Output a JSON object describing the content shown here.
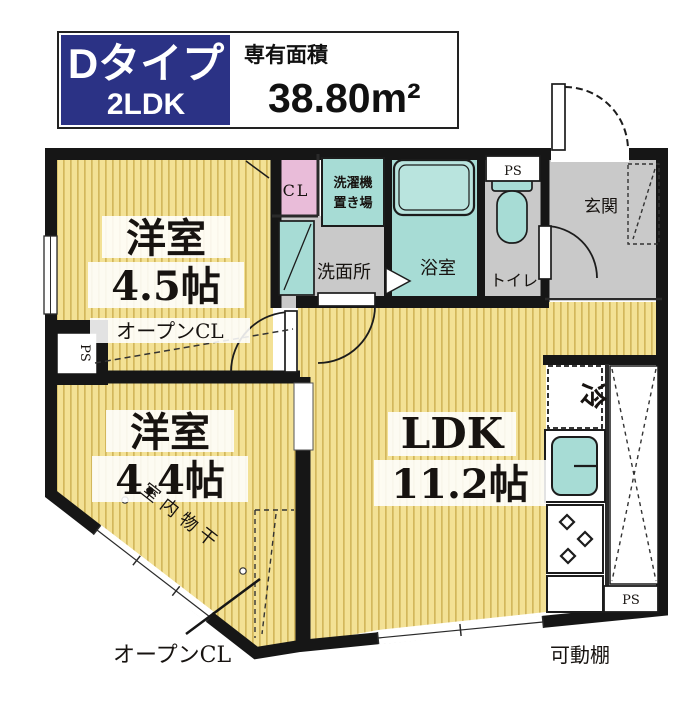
{
  "header": {
    "type_label": "Dタイプ",
    "layout_label": "2LDK",
    "area_caption": "専有面積",
    "area_value": "38.80m²"
  },
  "rooms": {
    "bedroom1_name": "洋室",
    "bedroom1_size": "4.5帖",
    "bedroom2_name": "洋室",
    "bedroom2_size": "4.4帖",
    "ldk_name": "LDK",
    "ldk_size": "11.2帖",
    "closet": "CL",
    "laundry_line1": "洗濯機",
    "laundry_line2": "置き場",
    "washroom": "洗面所",
    "bathroom": "浴室",
    "toilet": "トイレ",
    "entrance": "玄関"
  },
  "annotations": {
    "open_closet_upper": "オープンCL",
    "open_closet_lower": "オープンCL",
    "indoor_drying": "室内物干",
    "movable_shelf": "可動棚",
    "fridge": "冷",
    "ps_left": "PS",
    "ps_toilet": "PS",
    "ps_kitchen": "PS"
  },
  "colors": {
    "accent_navy": "#2b3285",
    "floor_yellow": "#f3e195",
    "floor_stripe": "#d3b75c",
    "wet_teal": "#a7dcd5",
    "bathtub_teal": "#b9e4de",
    "hall_gray": "#c9c9c9",
    "closet_pink": "#e9bcd9",
    "wall_black": "#161616"
  }
}
